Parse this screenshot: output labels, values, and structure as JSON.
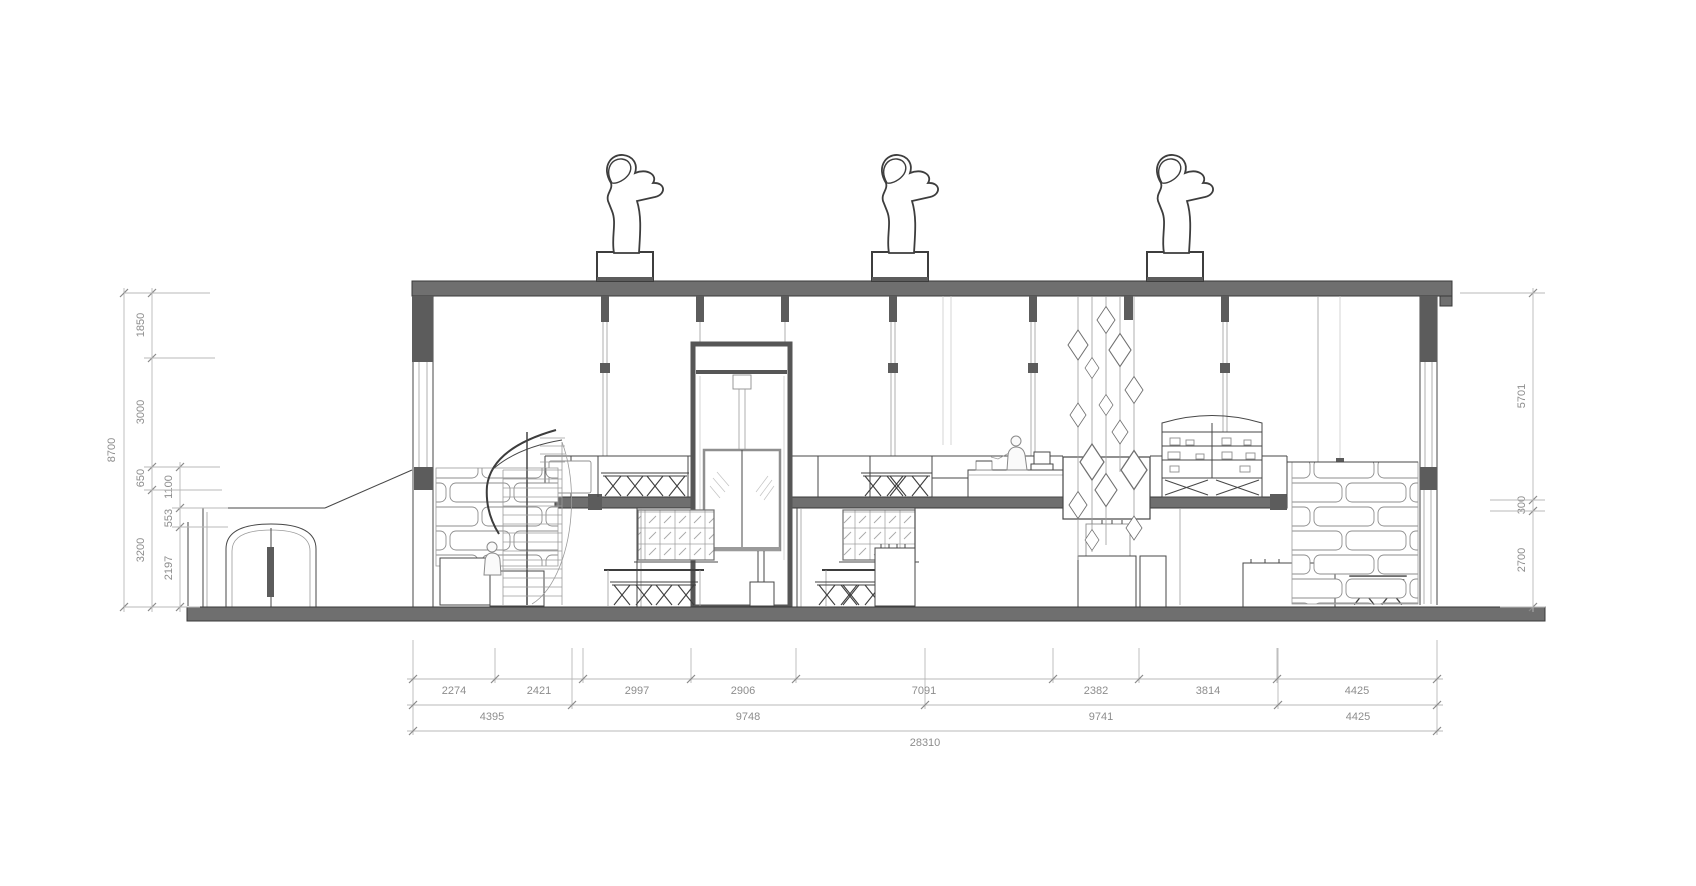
{
  "drawing": {
    "kind": "building-section-elevation",
    "palette": {
      "slab_fill": "#6f6f6f",
      "line_dark": "#474747",
      "line_light": "#9b9b9b",
      "dimension_line": "#b8b8b8",
      "dimension_text": "#8d8d8d",
      "background": "#ffffff"
    }
  },
  "dimensions": {
    "left": {
      "overall": "8700",
      "wall": [
        "1850",
        "3000",
        "650",
        "3200"
      ],
      "inner": [
        "1100",
        "553",
        "2197"
      ]
    },
    "right": [
      "5701",
      "300",
      "2700"
    ],
    "bottom": {
      "row1": [
        "2274",
        "2421",
        "2997",
        "2906",
        "7091",
        "2382",
        "3814",
        "4425"
      ],
      "row2": [
        "4395",
        "9748",
        "9741",
        "4425"
      ],
      "total": "28310"
    }
  }
}
